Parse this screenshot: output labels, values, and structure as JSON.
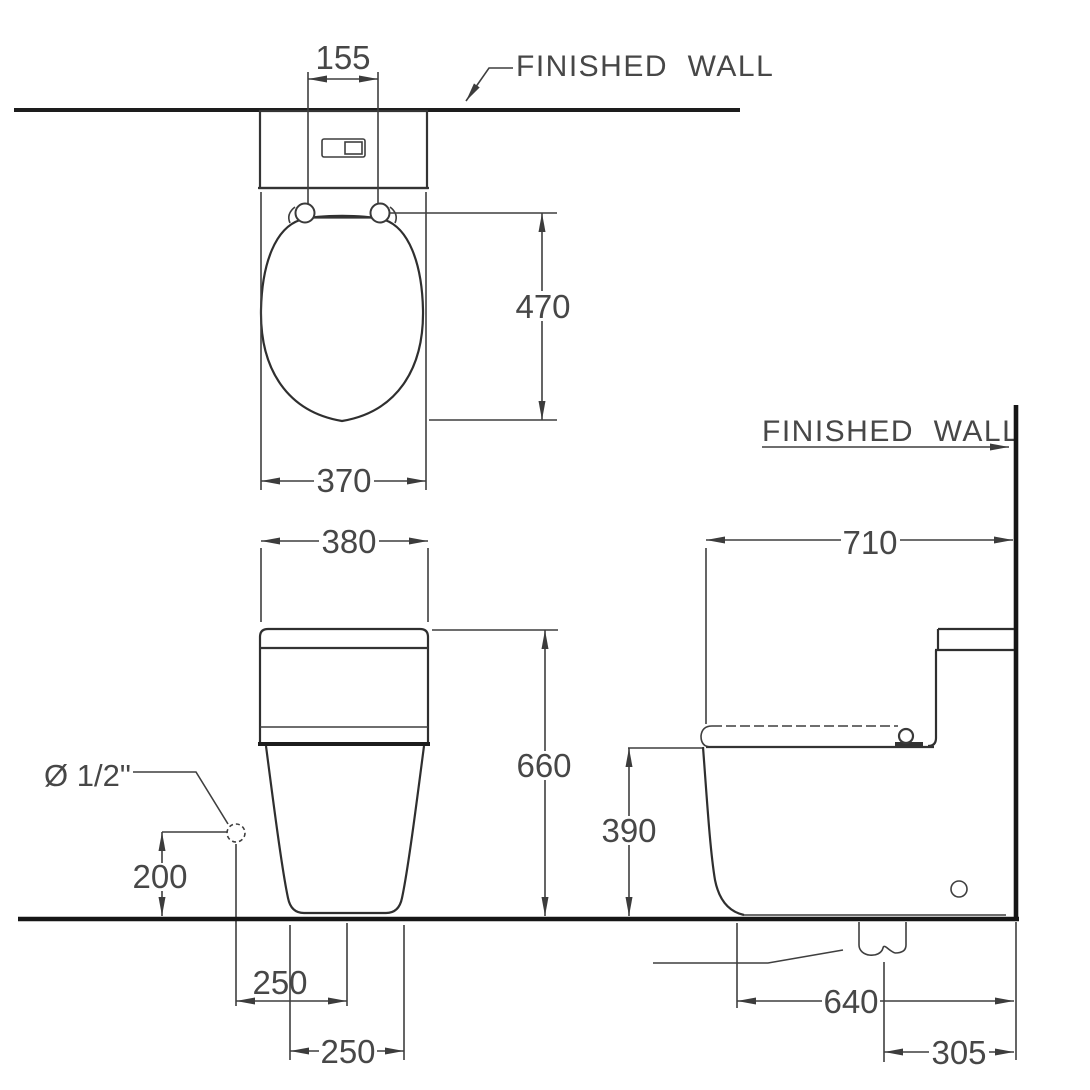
{
  "drawing_type": "toilet-installation-dimension-diagram",
  "views": {
    "plan": {
      "wall_label": "FINISHED  WALL",
      "dims": {
        "flush_spacing": "155",
        "seat_depth": "470",
        "seat_width": "370"
      }
    },
    "front": {
      "supply_label": "Ø 1/2\"",
      "dims": {
        "tank_width": "380",
        "overall_height": "660",
        "supply_height": "200",
        "supply_offset": "250",
        "base_width": "250"
      }
    },
    "side": {
      "wall_label": "FINISHED  WALL",
      "dims": {
        "overall_depth": "710",
        "rim_height": "390",
        "base_depth": "640",
        "outlet_offset": "305"
      }
    }
  },
  "colors": {
    "line": "#3f3f3f",
    "heavy_line": "#161616",
    "text": "#474747",
    "background": "#ffffff"
  }
}
